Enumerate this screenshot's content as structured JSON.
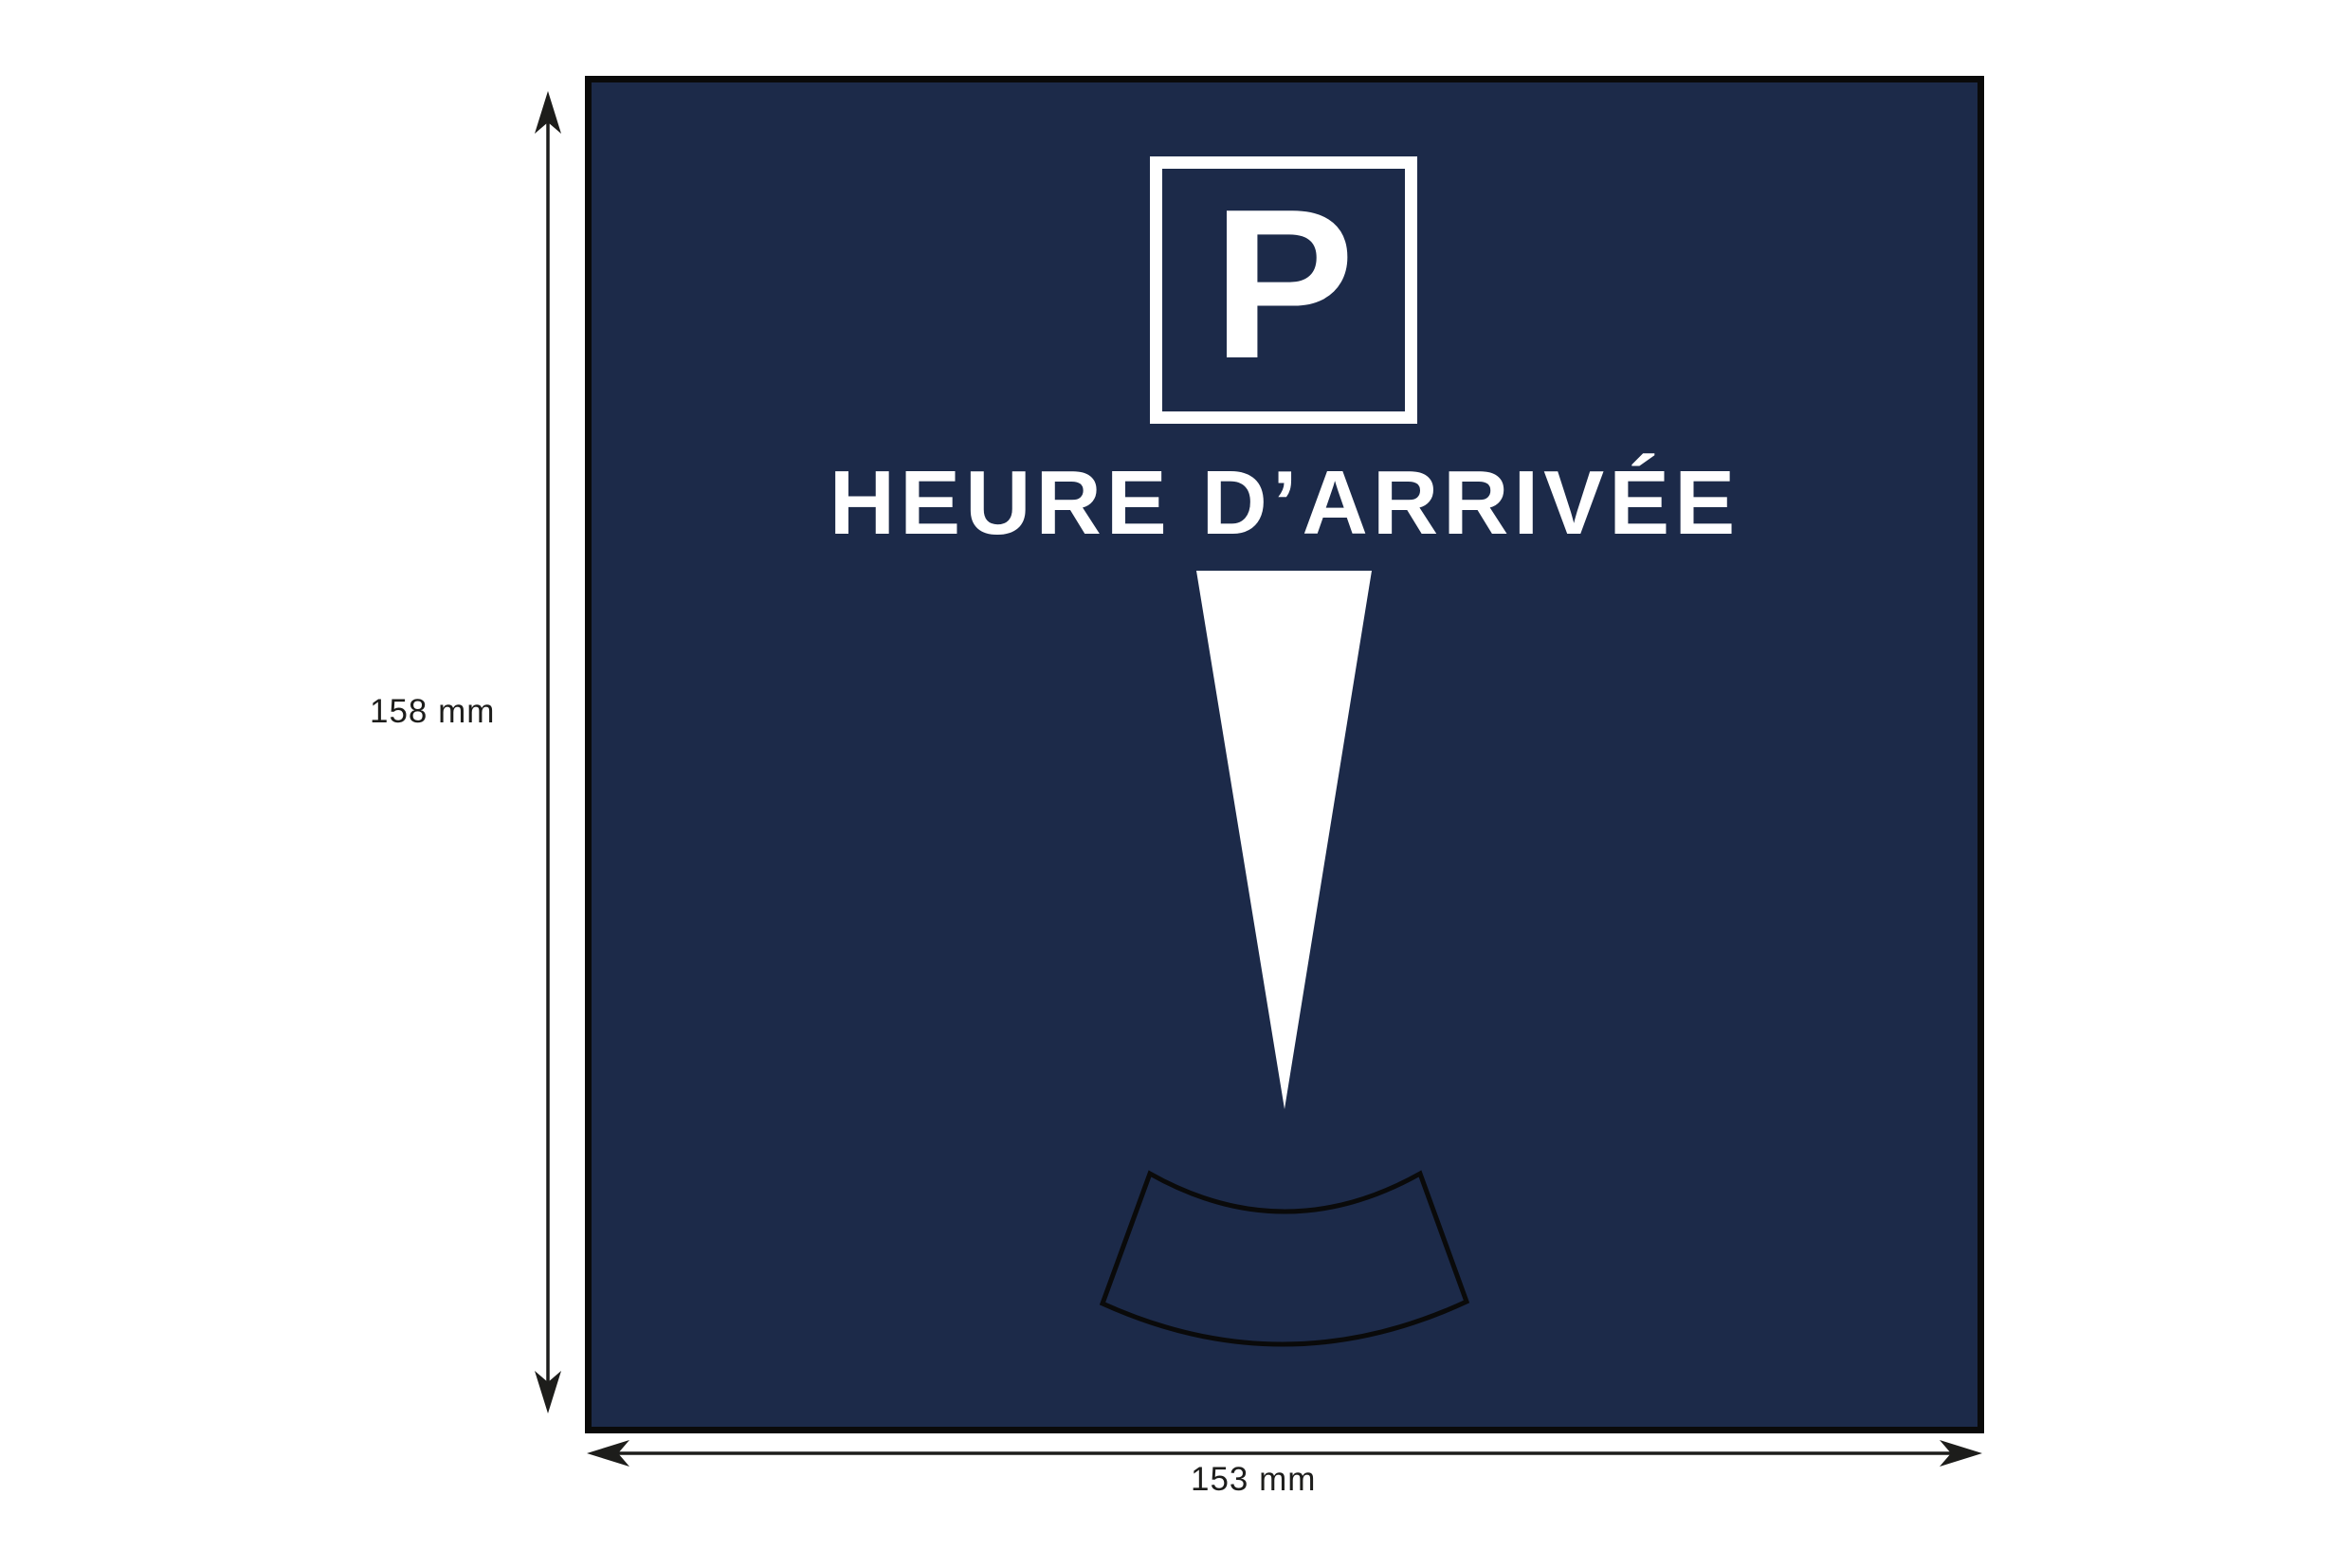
{
  "diagram": {
    "panel": {
      "parking_symbol": "P",
      "title": "HEURE D’ARRIVÉE"
    },
    "dimensions": {
      "height_label": "158 mm",
      "width_label": "153 mm"
    },
    "colors": {
      "panel_background": "#1c2a49",
      "panel_border": "#0a0a0a",
      "artwork_white": "#ffffff",
      "dimension_ink": "#1d1d1b"
    }
  }
}
